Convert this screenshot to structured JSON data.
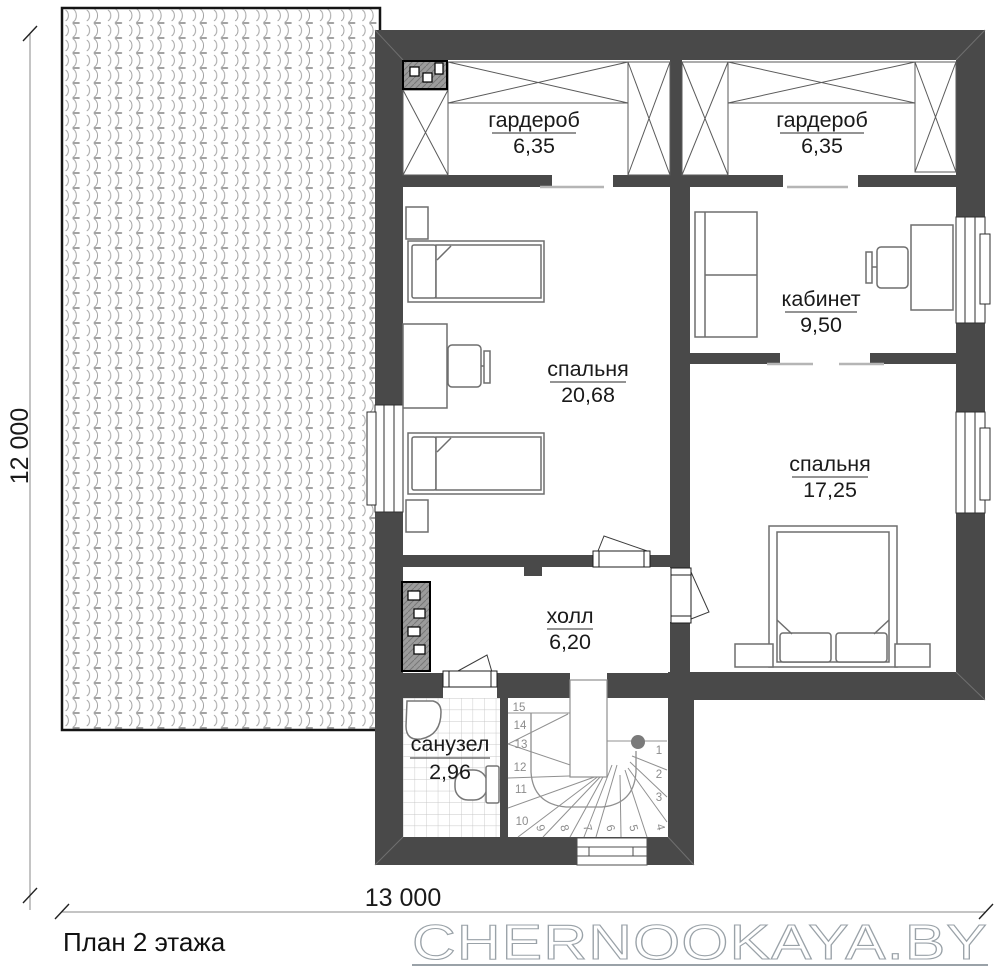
{
  "plan": {
    "title": "План 2 этажа",
    "watermark": "CHERNOOKAYA.BY"
  },
  "dimensions": {
    "height_label": "12 000",
    "width_label": "13 000"
  },
  "rooms": {
    "wardrobe_left": {
      "name": "гардероб",
      "area": "6,35"
    },
    "wardrobe_right": {
      "name": "гардероб",
      "area": "6,35"
    },
    "bedroom_large": {
      "name": "спальня",
      "area": "20,68"
    },
    "office": {
      "name": "кабинет",
      "area": "9,50"
    },
    "bedroom_small": {
      "name": "спальня",
      "area": "17,25"
    },
    "hall": {
      "name": "холл",
      "area": "6,20"
    },
    "bathroom": {
      "name": "санузел",
      "area": "2,96"
    }
  },
  "stairs": {
    "steps": [
      "1",
      "2",
      "3",
      "4",
      "5",
      "6",
      "7",
      "8",
      "9",
      "10",
      "11",
      "12",
      "13",
      "14",
      "15"
    ]
  },
  "colors": {
    "wall": "#494949",
    "furniture_line": "#6e6e6e",
    "stair_line": "#909090",
    "tile_line": "#c6c6c6",
    "roof_tile_line": "#a3a3a3",
    "threshold": "#b5b5b5",
    "dimension_line": "#888888",
    "watermark": "#9aa2a8",
    "text": "#1a1a1a"
  }
}
